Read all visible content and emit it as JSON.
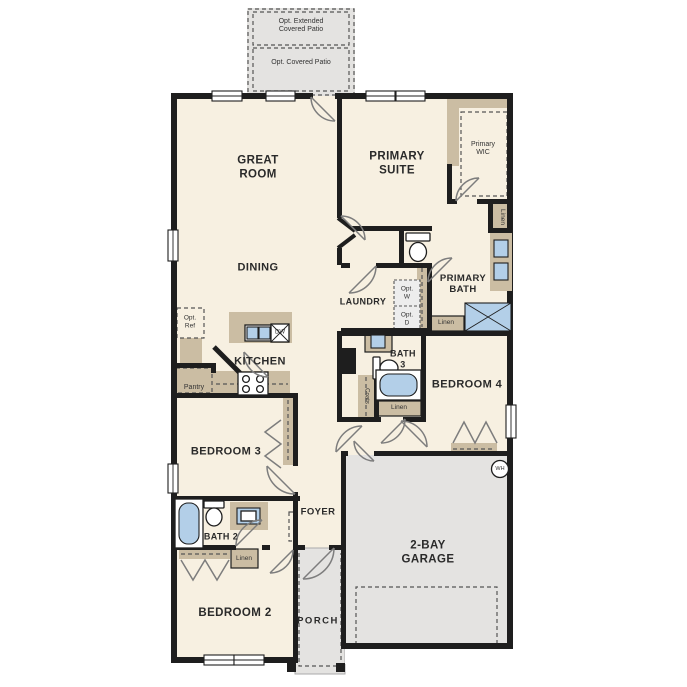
{
  "colors": {
    "floor": "#f7f0e1",
    "outdoor": "#e4e3e1",
    "cabinet": "#cbbda3",
    "wall": "#1e1e1e",
    "fixture_blue": "#b3cfe8",
    "door": "#7d7d7d",
    "dash": "#555555"
  },
  "labels": {
    "opt_extended_patio": "Opt. Extended\nCovered Patio",
    "opt_covered_patio": "Opt. Covered Patio",
    "great_room": "GREAT\nROOM",
    "primary_suite": "PRIMARY\nSUITE",
    "primary_wic": "Primary\nWIC",
    "linen_primary": "Linen",
    "dining": "DINING",
    "primary_bath": "PRIMARY\nBATH",
    "laundry": "LAUNDRY",
    "opt_washer": "Opt.\nW",
    "opt_dryer": "Opt.\nD",
    "linen_hall": "Linen",
    "opt_ref": "Opt.\nRef",
    "kitchen": "KITCHEN",
    "dishwasher": "DW",
    "pantry": "Pantry",
    "bath_3": "BATH\n3",
    "bedroom_4": "BEDROOM 4",
    "coats": "Coats",
    "linen_bath3": "Linen",
    "bedroom_3": "BEDROOM 3",
    "foyer": "FOYER",
    "water_heater": "WH",
    "bath_2": "BATH 2",
    "linen_bath2": "Linen",
    "bedroom_2": "BEDROOM 2",
    "porch": "PORCH",
    "garage": "2-BAY\nGARAGE"
  }
}
